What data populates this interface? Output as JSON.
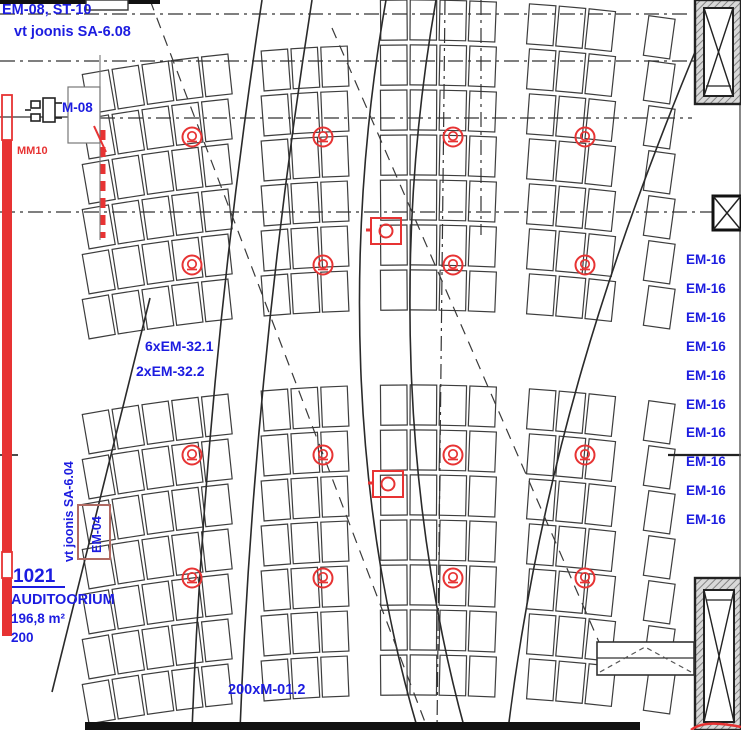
{
  "drawing": {
    "annotations": {
      "top_left_line1": "EM-08, ST-10",
      "top_left_line2": "vt joonis SA-6.08",
      "motor_label": "M-08",
      "mm10_label": "MM10",
      "fixture_count_1": "6xEM-32.1",
      "fixture_count_2": "2xEM-32.2",
      "seat_count_label": "200xM-01.2",
      "side_ref_label": "vt joonis SA-6.04",
      "em04_label": "EM-04"
    },
    "room": {
      "number": "1021",
      "name": "AUDITOORIUM",
      "area": "196,8 m²",
      "capacity": "200"
    },
    "right_labels": [
      "EM-16",
      "EM-16",
      "EM-16",
      "EM-16",
      "EM-16",
      "EM-16",
      "EM-16",
      "EM-16",
      "EM-16",
      "EM-16"
    ],
    "colors": {
      "annotation_blue": "#1c1ce0",
      "marker_red": "#e73333",
      "line_dark": "#333333"
    },
    "symbols": {
      "speaker_columns_x": [
        192,
        323,
        453,
        585
      ],
      "speaker_rows_y": [
        137,
        265,
        455,
        578
      ],
      "square_fixtures": [
        [
          386,
          231
        ],
        [
          388,
          484
        ]
      ]
    }
  }
}
